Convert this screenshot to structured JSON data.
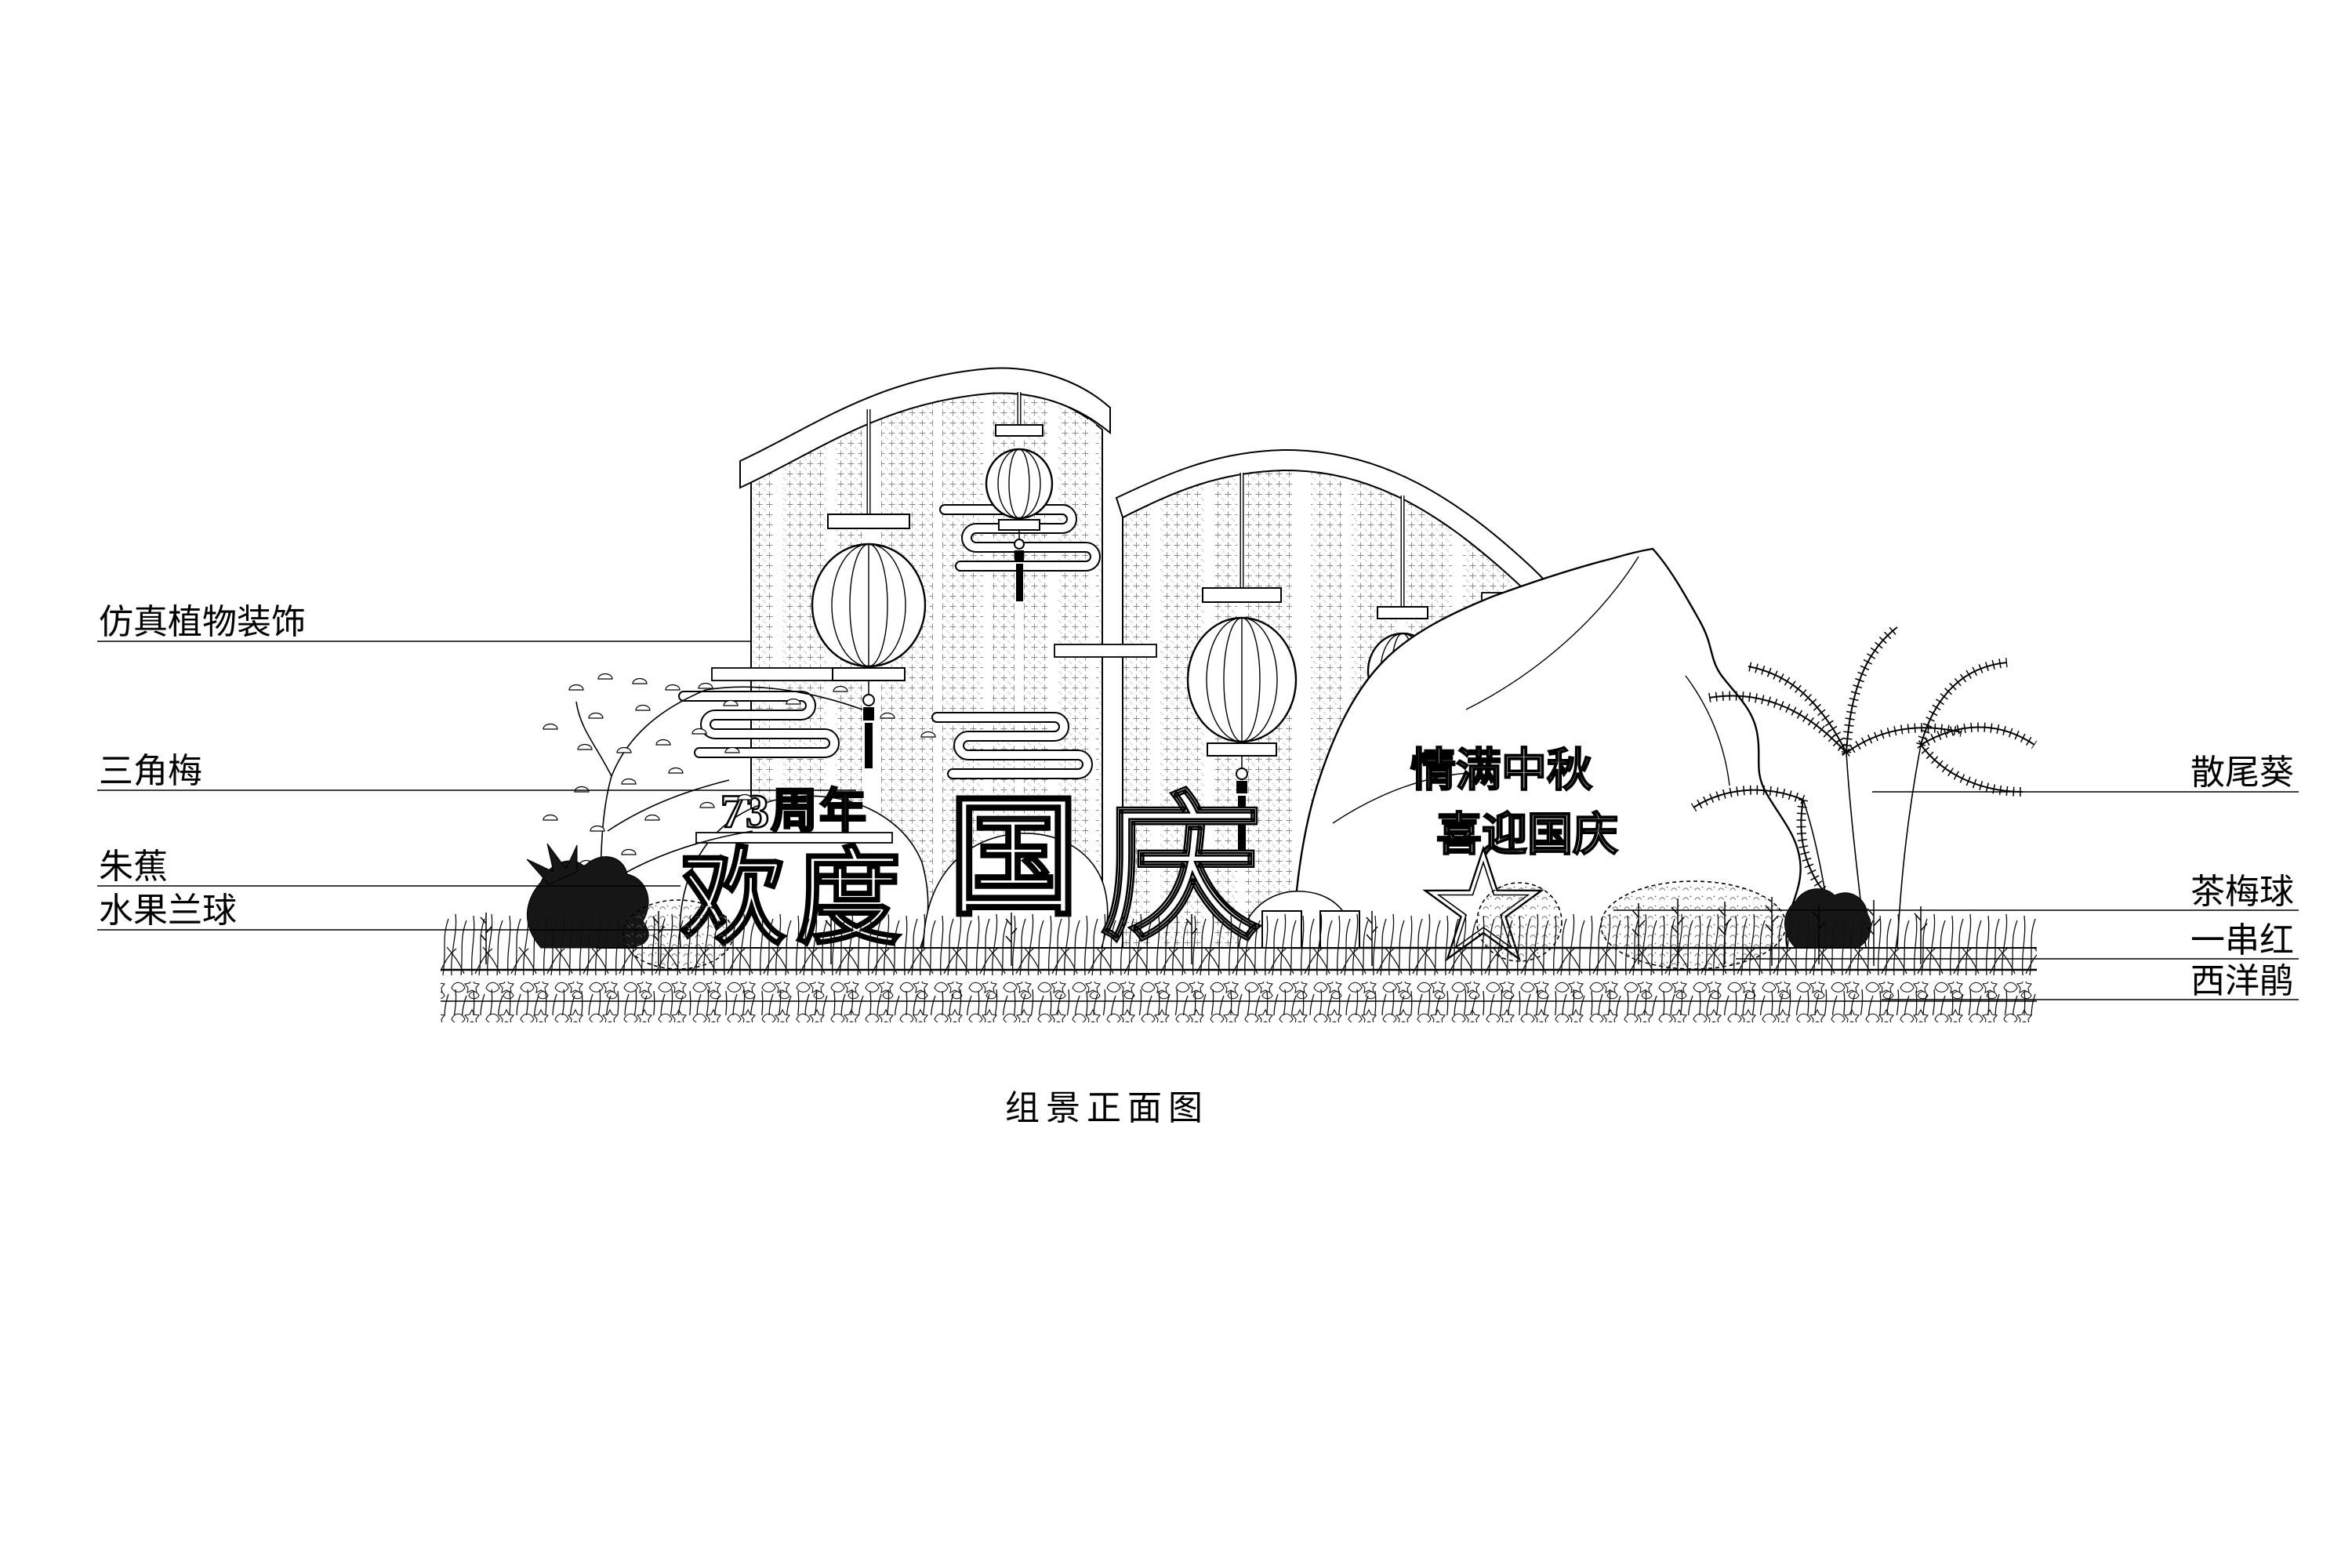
{
  "page": {
    "background": "#ffffff",
    "ink": "#000000",
    "hatch_gray": "#8a8a8a",
    "drawing_type": "landscape elevation line drawing"
  },
  "caption": {
    "text": "组景正面图"
  },
  "labels": {
    "left": [
      {
        "text": "仿真植物装饰"
      },
      {
        "text": "三角梅"
      },
      {
        "text": "朱蕉"
      },
      {
        "text": "水果兰球"
      }
    ],
    "right": [
      {
        "text": "散尾葵"
      },
      {
        "text": "茶梅球"
      },
      {
        "text": "一串红"
      },
      {
        "text": "西洋鹃"
      }
    ]
  },
  "signage": {
    "anniversary": "73周年",
    "greeting_full": "欢度国庆",
    "char_huan": "欢",
    "char_du": "度",
    "char_guo": "国",
    "char_qing": "庆",
    "rock_line_1": "情满中秋",
    "rock_line_2": "喜迎国庆"
  },
  "decorations": {
    "lantern_count": 4,
    "cloud_scroll_count": 4,
    "star_count": 1
  }
}
